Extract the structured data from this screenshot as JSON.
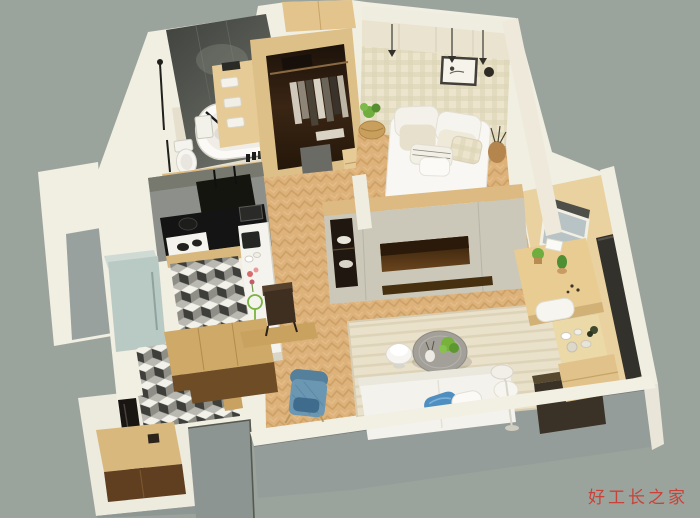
{
  "scene": {
    "type": "3d-isometric-cutaway-floorplan-render",
    "background": "#9ba49c"
  },
  "watermark": {
    "text": "好工长之家"
  },
  "palette": {
    "background": "#9ba49c",
    "wall": "#f1eee2",
    "wall_band": "#f2efe3",
    "wall_face_grey": "#959d9a",
    "bath_wall_dark": "#54564f",
    "wood_light": "#dcba82",
    "wood_mid": "#c9a263",
    "wood_dark": "#6e4c26",
    "floor_wood": "#ddb27b",
    "tv_wall": "#cbc7b9",
    "niche_brown": "#53361a",
    "closet_dark": "#2c1c10",
    "kitchen_wall_grey": "#8d908a",
    "counter_black": "#141414",
    "fridge_blue": "#b9cac5",
    "sofa_white": "#f4f2ec",
    "pillow_blue": "#4e8ec0",
    "armchair_blue": "#6b97b2",
    "table_grey": "#a3a099",
    "rug_beige": "#eae1cb",
    "glass_blue": "#b7c3c5",
    "wardrobe_dark": "#33312b",
    "plant_green": "#6fae3e",
    "watermark_red": "#c8423a"
  },
  "rooms": [
    {
      "name": "bathroom",
      "items": [
        "bathtub",
        "toilet",
        "shower-fixture",
        "towel-shelf"
      ]
    },
    {
      "name": "walk-in-closet",
      "items": [
        "hanging-clothes",
        "drawers",
        "stool"
      ]
    },
    {
      "name": "bedroom",
      "items": [
        "double-bed",
        "pillows",
        "wall-art",
        "pendant-lights",
        "overhead-cabinets",
        "bedside-plant",
        "vase"
      ]
    },
    {
      "name": "kitchen",
      "items": [
        "black-countertop",
        "gas-stove",
        "range-hood",
        "bar-counter",
        "coffee-machine",
        "refrigerator",
        "checkered-tile-floor"
      ]
    },
    {
      "name": "living-room",
      "items": [
        "white-sofa",
        "blue-pillow",
        "round-coffee-table",
        "side-table",
        "blue-armchair",
        "striped-rug",
        "floor-lamp",
        "tv-wall",
        "sideboard"
      ]
    },
    {
      "name": "study-nook",
      "items": [
        "desk",
        "cactus",
        "window",
        "dark-wardrobe",
        "bench",
        "tea-table"
      ]
    },
    {
      "name": "entry",
      "items": [
        "shoe-cabinet",
        "mirror",
        "door-recess",
        "round-mat"
      ]
    }
  ]
}
